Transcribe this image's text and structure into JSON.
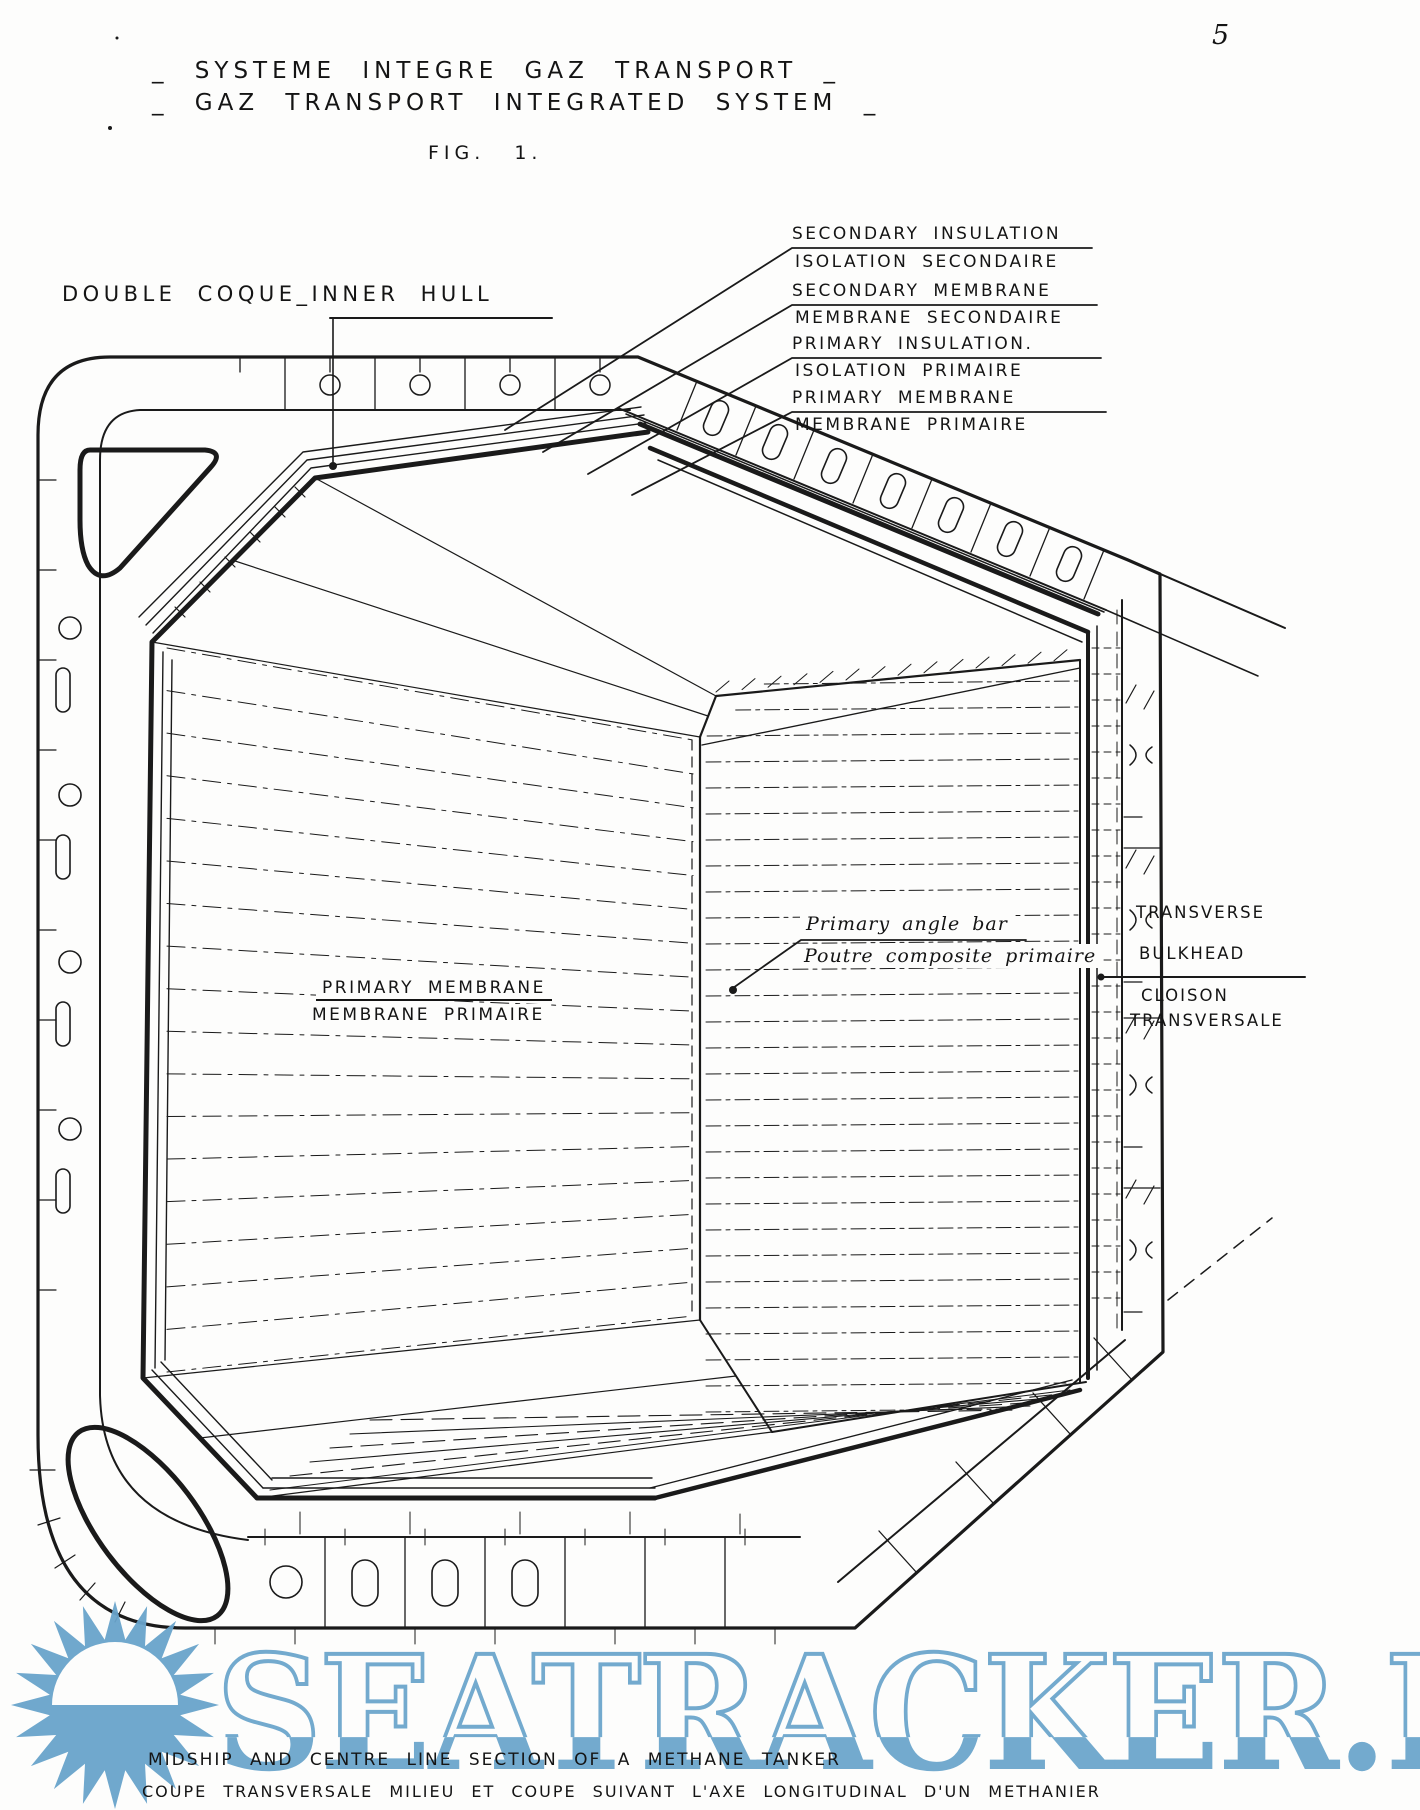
{
  "page": {
    "number": "5"
  },
  "title": {
    "line1": "_ SYSTEME INTEGRE GAZ TRANSPORT _",
    "line2": "_ GAZ TRANSPORT INTEGRATED SYSTEM _"
  },
  "figure_label": "FIG. 1.",
  "labels": {
    "inner_hull": "DOUBLE COQUE_INNER HULL",
    "layers": [
      {
        "en": "SECONDARY INSULATION",
        "fr": "ISOLATION SECONDAIRE"
      },
      {
        "en": "SECONDARY MEMBRANE",
        "fr": "MEMBRANE SECONDAIRE"
      },
      {
        "en": "PRIMARY INSULATION.",
        "fr": "ISOLATION PRIMAIRE"
      },
      {
        "en": "PRIMARY MEMBRANE",
        "fr": "MEMBRANE PRIMAIRE"
      }
    ],
    "primary_membrane": {
      "en": "PRIMARY MEMBRANE",
      "fr": "MEMBRANE PRIMAIRE"
    },
    "angle_bar": {
      "en": "Primary angle bar",
      "fr": "Poutre composite primaire"
    },
    "bulkhead": {
      "en_line1": "TRANSVERSE",
      "en_line2": "BULKHEAD",
      "fr_line1": "CLOISON",
      "fr_line2": "TRANSVERSALE"
    }
  },
  "caption": {
    "en": "MIDSHIP AND CENTRE LINE SECTION OF A METHANE TANKER",
    "fr": "COUPE TRANSVERSALE MILIEU ET COUPE SUIVANT L'AXE LONGITUDINAL D'UN METHANIER"
  },
  "watermark": {
    "text": "SEATRACKER.RU",
    "color": "#69a4cb",
    "icon": "sun-icon"
  },
  "colors": {
    "ink": "#1a1a1a",
    "paper": "#fdfdfc"
  }
}
